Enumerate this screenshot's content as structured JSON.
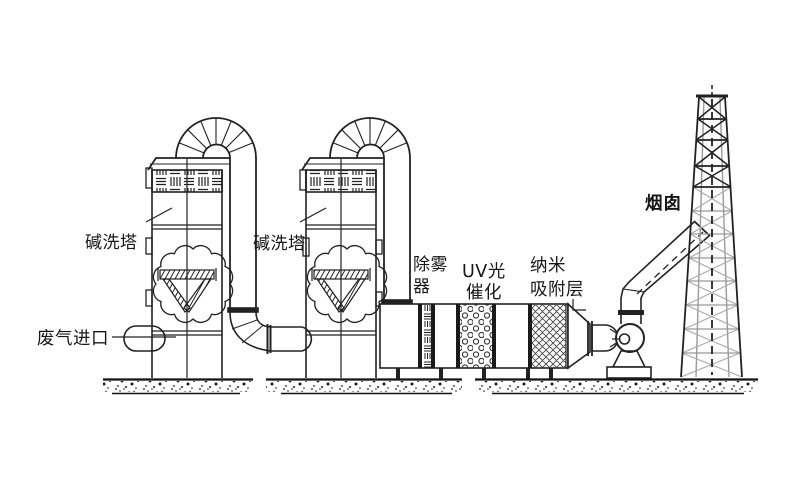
{
  "diagram": {
    "type": "waste-gas-treatment-process-flow",
    "labels": {
      "tower1": "碱洗塔",
      "tower2": "碱洗塔",
      "waste_gas_inlet": "废气进口",
      "demister_line1": "除雾",
      "demister_line2": "器",
      "uv_line1": "UV光",
      "uv_line2": "催化",
      "nano_line1": "纳米",
      "nano_line2": "吸附层",
      "chimney": "烟囱"
    },
    "colors": {
      "line": "#1f1f1f",
      "light_line": "#9a9a9a",
      "background": "#ffffff"
    }
  }
}
